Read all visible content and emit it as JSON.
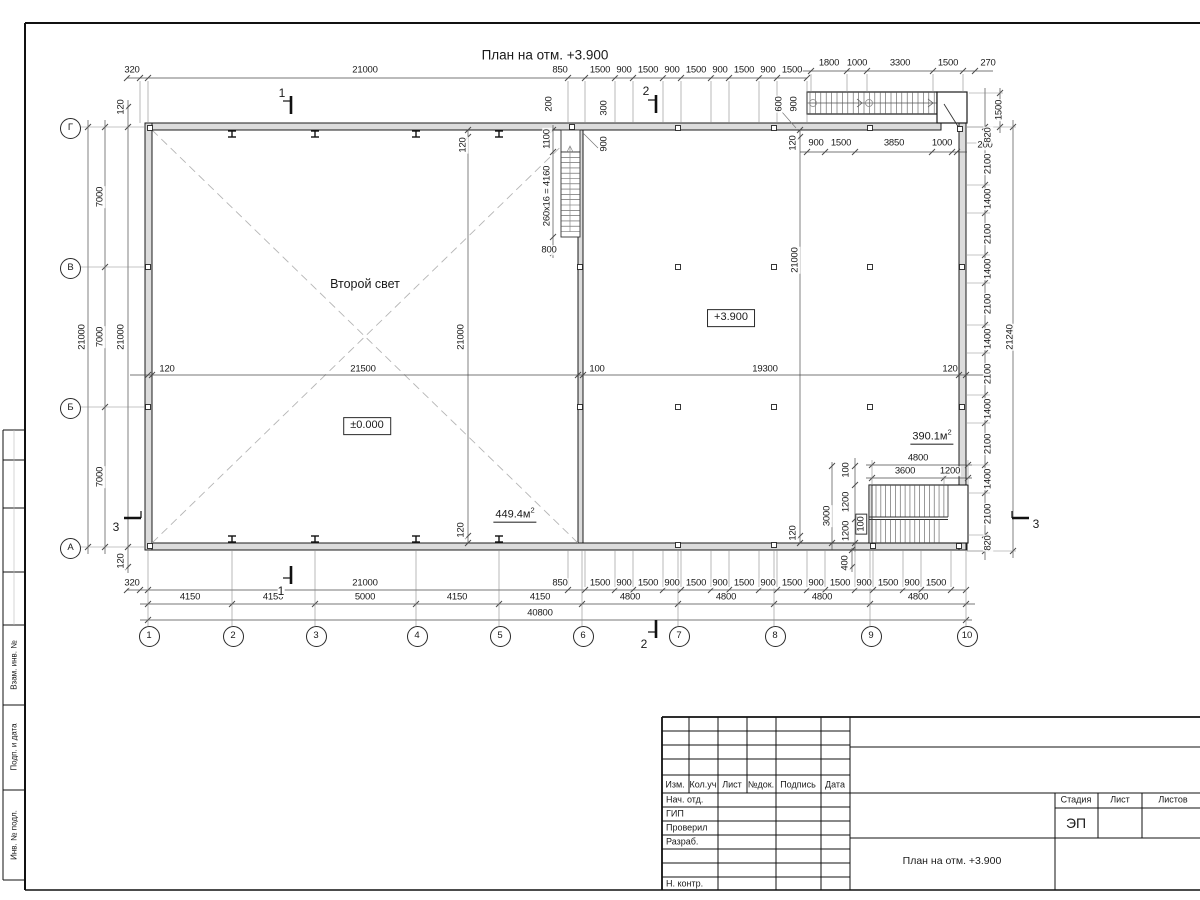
{
  "title": "План на отм. +3.900",
  "plan": {
    "room_label": {
      "t": "Второй свет",
      "x": 365,
      "y": 284
    },
    "level_marks": [
      {
        "t": "±0.000",
        "x": 367,
        "y": 426
      },
      {
        "t": "+3.900",
        "x": 731,
        "y": 318
      }
    ],
    "area_labels": [
      {
        "base": "449.4м",
        "sup": "2",
        "x": 515,
        "y": 514
      },
      {
        "base": "390.1м",
        "sup": "2",
        "x": 932,
        "y": 436
      }
    ],
    "section_labels": [
      {
        "t": "1",
        "x": 282,
        "y": 93
      },
      {
        "t": "1",
        "x": 281,
        "y": 591
      },
      {
        "t": "2",
        "x": 646,
        "y": 91
      },
      {
        "t": "2",
        "x": 644,
        "y": 644
      },
      {
        "t": "3",
        "x": 116,
        "y": 527
      },
      {
        "t": "3",
        "x": 1036,
        "y": 524
      }
    ],
    "axes": {
      "cols": [
        {
          "t": "1",
          "x": 148
        },
        {
          "t": "2",
          "x": 232
        },
        {
          "t": "3",
          "x": 315
        },
        {
          "t": "4",
          "x": 416
        },
        {
          "t": "5",
          "x": 499
        },
        {
          "t": "6",
          "x": 582
        },
        {
          "t": "7",
          "x": 678
        },
        {
          "t": "8",
          "x": 774
        },
        {
          "t": "9",
          "x": 870
        },
        {
          "t": "10",
          "x": 966
        }
      ],
      "rows": [
        {
          "t": "Г",
          "y": 127
        },
        {
          "t": "В",
          "y": 267
        },
        {
          "t": "Б",
          "y": 407
        },
        {
          "t": "А",
          "y": 547
        }
      ]
    },
    "dim_labels": [
      {
        "t": "320",
        "x": 132,
        "y": 70
      },
      {
        "t": "21000",
        "x": 365,
        "y": 70
      },
      {
        "t": "850",
        "x": 560,
        "y": 70
      },
      {
        "t": "1500",
        "x": 600,
        "y": 70
      },
      {
        "t": "900",
        "x": 624,
        "y": 70
      },
      {
        "t": "1500",
        "x": 648,
        "y": 70
      },
      {
        "t": "900",
        "x": 672,
        "y": 70
      },
      {
        "t": "1500",
        "x": 696,
        "y": 70
      },
      {
        "t": "900",
        "x": 720,
        "y": 70
      },
      {
        "t": "1500",
        "x": 744,
        "y": 70
      },
      {
        "t": "900",
        "x": 768,
        "y": 70
      },
      {
        "t": "1500",
        "x": 792,
        "y": 70
      },
      {
        "t": "1800",
        "x": 829,
        "y": 63
      },
      {
        "t": "1000",
        "x": 857,
        "y": 63
      },
      {
        "t": "3300",
        "x": 900,
        "y": 63
      },
      {
        "t": "1500",
        "x": 948,
        "y": 63
      },
      {
        "t": "270",
        "x": 988,
        "y": 63
      },
      {
        "t": "120",
        "x": 121,
        "y": 107,
        "r": 1
      },
      {
        "t": "200",
        "x": 549,
        "y": 104,
        "r": 1
      },
      {
        "t": "300",
        "x": 604,
        "y": 108,
        "r": 1
      },
      {
        "t": "600",
        "x": 779,
        "y": 104,
        "r": 1
      },
      {
        "t": "900",
        "x": 794,
        "y": 104,
        "r": 1
      },
      {
        "t": "1500",
        "x": 999,
        "y": 110,
        "r": 1
      },
      {
        "t": "1100",
        "x": 547,
        "y": 139,
        "r": 1
      },
      {
        "t": "260x16 = 4160",
        "x": 547,
        "y": 196,
        "r": 1
      },
      {
        "t": "800",
        "x": 549,
        "y": 250
      },
      {
        "t": "900",
        "x": 604,
        "y": 144,
        "r": 1
      },
      {
        "t": "120",
        "x": 463,
        "y": 145,
        "r": 1
      },
      {
        "t": "120",
        "x": 793,
        "y": 143,
        "r": 1
      },
      {
        "t": "900",
        "x": 816,
        "y": 143
      },
      {
        "t": "1500",
        "x": 841,
        "y": 143
      },
      {
        "t": "3850",
        "x": 894,
        "y": 143
      },
      {
        "t": "1000",
        "x": 942,
        "y": 143
      },
      {
        "t": "200",
        "x": 985,
        "y": 145
      },
      {
        "t": "120",
        "x": 167,
        "y": 369
      },
      {
        "t": "21500",
        "x": 363,
        "y": 369
      },
      {
        "t": "100",
        "x": 597,
        "y": 369
      },
      {
        "t": "19300",
        "x": 765,
        "y": 369
      },
      {
        "t": "120",
        "x": 950,
        "y": 369
      },
      {
        "t": "21000",
        "x": 461,
        "y": 337,
        "r": 1
      },
      {
        "t": "120",
        "x": 461,
        "y": 530,
        "r": 1
      },
      {
        "t": "21000",
        "x": 795,
        "y": 260,
        "r": 1
      },
      {
        "t": "120",
        "x": 793,
        "y": 533,
        "r": 1
      },
      {
        "t": "21000",
        "x": 82,
        "y": 337,
        "r": 1
      },
      {
        "t": "7000",
        "x": 100,
        "y": 197,
        "r": 1
      },
      {
        "t": "7000",
        "x": 100,
        "y": 337,
        "r": 1
      },
      {
        "t": "7000",
        "x": 100,
        "y": 477,
        "r": 1
      },
      {
        "t": "21000",
        "x": 121,
        "y": 337,
        "r": 1
      },
      {
        "t": "120",
        "x": 121,
        "y": 561,
        "r": 1
      },
      {
        "t": "820",
        "x": 988,
        "y": 135,
        "r": 1
      },
      {
        "t": "2100",
        "x": 988,
        "y": 164,
        "r": 1
      },
      {
        "t": "1400",
        "x": 988,
        "y": 199,
        "r": 1
      },
      {
        "t": "2100",
        "x": 988,
        "y": 234,
        "r": 1
      },
      {
        "t": "1400",
        "x": 988,
        "y": 269,
        "r": 1
      },
      {
        "t": "2100",
        "x": 988,
        "y": 304,
        "r": 1
      },
      {
        "t": "1400",
        "x": 988,
        "y": 339,
        "r": 1
      },
      {
        "t": "2100",
        "x": 988,
        "y": 374,
        "r": 1
      },
      {
        "t": "1400",
        "x": 988,
        "y": 409,
        "r": 1
      },
      {
        "t": "2100",
        "x": 988,
        "y": 444,
        "r": 1
      },
      {
        "t": "1400",
        "x": 988,
        "y": 479,
        "r": 1
      },
      {
        "t": "2100",
        "x": 988,
        "y": 514,
        "r": 1
      },
      {
        "t": "820",
        "x": 988,
        "y": 543,
        "r": 1
      },
      {
        "t": "21240",
        "x": 1010,
        "y": 337,
        "r": 1
      },
      {
        "t": "4800",
        "x": 918,
        "y": 458
      },
      {
        "t": "3600",
        "x": 905,
        "y": 471
      },
      {
        "t": "1200",
        "x": 950,
        "y": 471
      },
      {
        "t": "3000",
        "x": 827,
        "y": 516,
        "r": 1
      },
      {
        "t": "100",
        "x": 846,
        "y": 470,
        "r": 1
      },
      {
        "t": "1200",
        "x": 846,
        "y": 502,
        "r": 1
      },
      {
        "t": "1200",
        "x": 846,
        "y": 531,
        "r": 1
      },
      {
        "t": "100",
        "x": 861,
        "y": 524,
        "r": 1,
        "box": 1
      },
      {
        "t": "400",
        "x": 845,
        "y": 563,
        "r": 1
      },
      {
        "t": "320",
        "x": 132,
        "y": 583
      },
      {
        "t": "21000",
        "x": 365,
        "y": 583
      },
      {
        "t": "850",
        "x": 560,
        "y": 583
      },
      {
        "t": "1500",
        "x": 600,
        "y": 583
      },
      {
        "t": "900",
        "x": 624,
        "y": 583
      },
      {
        "t": "1500",
        "x": 648,
        "y": 583
      },
      {
        "t": "900",
        "x": 672,
        "y": 583
      },
      {
        "t": "1500",
        "x": 696,
        "y": 583
      },
      {
        "t": "900",
        "x": 720,
        "y": 583
      },
      {
        "t": "1500",
        "x": 744,
        "y": 583
      },
      {
        "t": "900",
        "x": 768,
        "y": 583
      },
      {
        "t": "1500",
        "x": 792,
        "y": 583
      },
      {
        "t": "900",
        "x": 816,
        "y": 583
      },
      {
        "t": "1500",
        "x": 840,
        "y": 583
      },
      {
        "t": "900",
        "x": 864,
        "y": 583
      },
      {
        "t": "1500",
        "x": 888,
        "y": 583
      },
      {
        "t": "900",
        "x": 912,
        "y": 583
      },
      {
        "t": "1500",
        "x": 936,
        "y": 583
      },
      {
        "t": "4150",
        "x": 190,
        "y": 597
      },
      {
        "t": "4150",
        "x": 273,
        "y": 597
      },
      {
        "t": "5000",
        "x": 365,
        "y": 597
      },
      {
        "t": "4150",
        "x": 457,
        "y": 597
      },
      {
        "t": "4150",
        "x": 540,
        "y": 597
      },
      {
        "t": "4800",
        "x": 630,
        "y": 597
      },
      {
        "t": "4800",
        "x": 726,
        "y": 597
      },
      {
        "t": "4800",
        "x": 822,
        "y": 597
      },
      {
        "t": "4800",
        "x": 918,
        "y": 597
      },
      {
        "t": "40800",
        "x": 540,
        "y": 613
      }
    ]
  },
  "frame_stamp": {
    "side_labels": [
      {
        "t": "Взам. инв. №",
        "y": 665
      },
      {
        "t": "Подп. и дата",
        "y": 747
      },
      {
        "t": "Инв. № подл.",
        "y": 835
      }
    ]
  },
  "titleblock": {
    "header_cols": [
      "Изм.",
      "Кол.уч",
      "Лист",
      "№док.",
      "Подпись",
      "Дата"
    ],
    "sign_rows": [
      "Нач. отд.",
      "ГИП",
      "Проверил",
      "Разраб.",
      "Н. контр."
    ],
    "stage_cols": [
      "Стадия",
      "Лист",
      "Листов"
    ],
    "stage_value": "ЭП",
    "doc_title": "План на отм. +3.900"
  },
  "colors": {
    "line": "#1c1c1c",
    "dim": "#4a4a4a",
    "light": "#8a8a8a",
    "wall_fill": "#dcdcdc",
    "dash": "#b5b5b5"
  }
}
